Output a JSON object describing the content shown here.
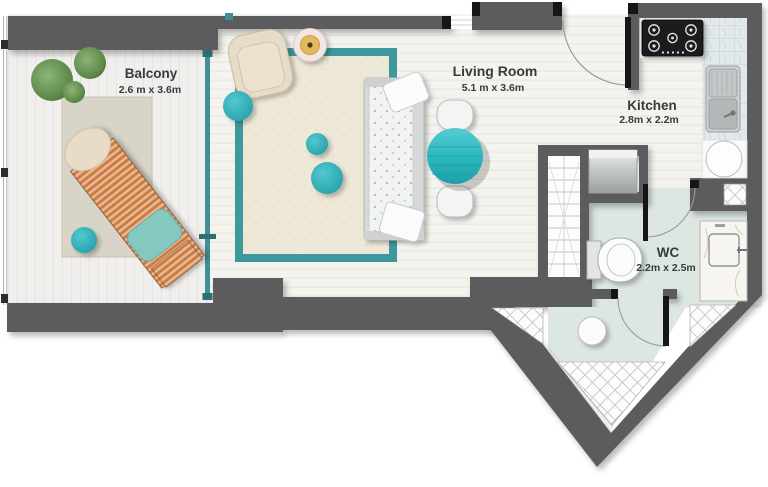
{
  "rooms": {
    "balcony": {
      "name": "Balcony",
      "size": "2.6 m x 3.6m"
    },
    "living_room": {
      "name": "Living Room",
      "size": "5.1 m x 3.6m"
    },
    "kitchen": {
      "name": "Kitchen",
      "size": "2.8m x 2.2m"
    },
    "wc": {
      "name": "WC",
      "size": "2.2m x 2.5m"
    }
  },
  "colors": {
    "wall": "#5b5c5e",
    "door_jamb": "#161616",
    "accent_teal": "#35b8c0",
    "rug_border_teal": "#3e999f",
    "glass_teal": "#3f9096",
    "wc_floor_mint": "#dde7e2",
    "wood_floor": "#f4f3ee",
    "label_text": "#3a3a3a",
    "stove_black": "#1c1c1c"
  }
}
